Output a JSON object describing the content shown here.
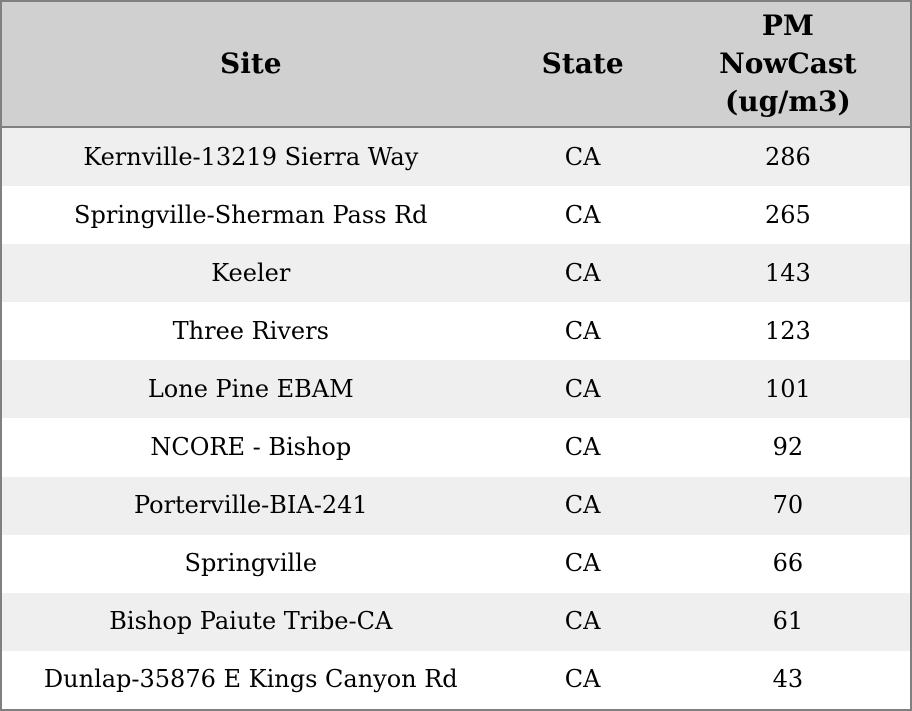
{
  "chart_data": {
    "type": "table",
    "title": "",
    "columns": [
      {
        "label": "Site"
      },
      {
        "label": "State"
      },
      {
        "label": "PM NowCast (ug/m3)",
        "label_lines": [
          "PM",
          "NowCast",
          "(ug/m3)"
        ]
      }
    ],
    "rows": [
      {
        "site": "Kernville-13219 Sierra Way",
        "state": "CA",
        "pm_nowcast": 286
      },
      {
        "site": "Springville-Sherman Pass Rd",
        "state": "CA",
        "pm_nowcast": 265
      },
      {
        "site": "Keeler",
        "state": "CA",
        "pm_nowcast": 143
      },
      {
        "site": "Three Rivers",
        "state": "CA",
        "pm_nowcast": 123
      },
      {
        "site": "Lone Pine EBAM",
        "state": "CA",
        "pm_nowcast": 101
      },
      {
        "site": "NCORE - Bishop",
        "state": "CA",
        "pm_nowcast": 92
      },
      {
        "site": "Porterville-BIA-241",
        "state": "CA",
        "pm_nowcast": 70
      },
      {
        "site": "Springville",
        "state": "CA",
        "pm_nowcast": 66
      },
      {
        "site": "Bishop Paiute Tribe-CA",
        "state": "CA",
        "pm_nowcast": 61
      },
      {
        "site": "Dunlap-35876 E Kings Canyon Rd",
        "state": "CA",
        "pm_nowcast": 43
      }
    ],
    "layout": {
      "grid": "alternating row shading, no column rules",
      "alignment": "all cells centered"
    },
    "colors": {
      "header_bg": "#d0d0d0",
      "row_alt_bg": "#efefef",
      "row_bg": "#ffffff",
      "border": "#808080",
      "text": "#000000"
    }
  }
}
